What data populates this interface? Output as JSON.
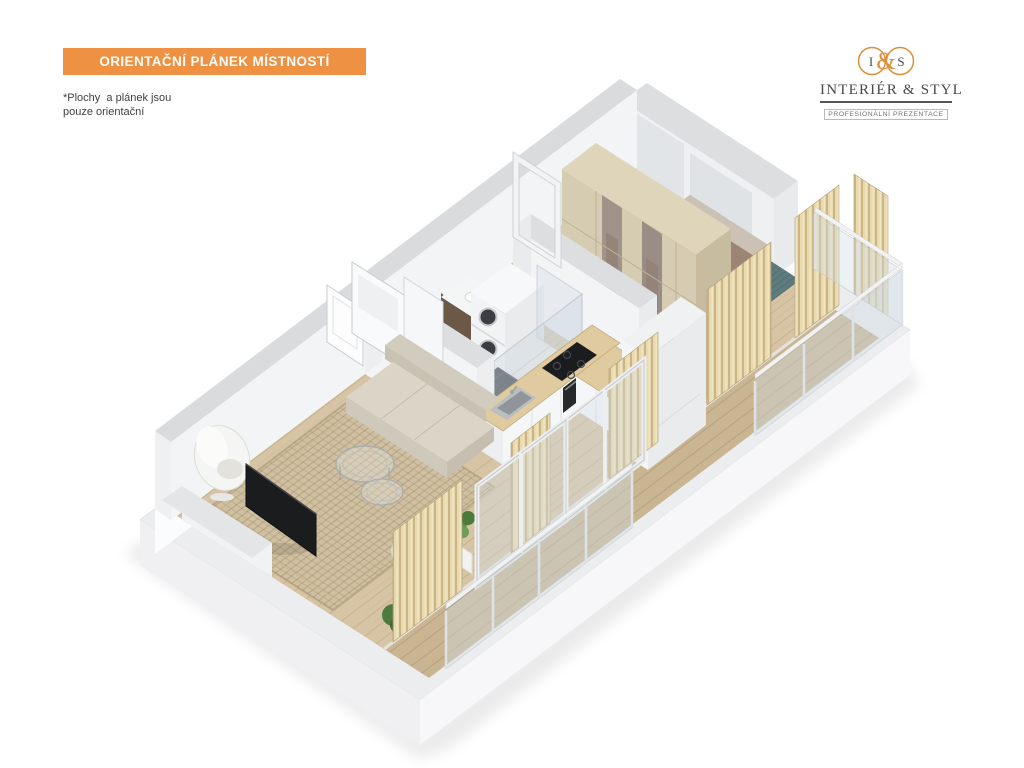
{
  "header": {
    "banner_title": "ORIENTAČNÍ PLÁNEK MÍSTNOSTÍ"
  },
  "note": {
    "line1": "*Plochy  a plánek jsou",
    "line2": "pouze orientační"
  },
  "logo": {
    "left_letter": "I",
    "ampersand": "&",
    "right_letter": "S",
    "name": "INTERIÉR & STYL",
    "tagline": "PROFESIONÁLNÍ PREZENTACE"
  },
  "palette": {
    "banner_orange": "#ef9143",
    "logo_orange": "#d8903d",
    "note_text": "#3f3f3f",
    "wall_top_gray": "#d9dbdd",
    "wall_face_white": "#f2f4f5",
    "floor_wood": "#d7c4a5",
    "balcony_wood": "#cab593",
    "bathroom_marble": "#edebe8",
    "living_rug_beige": "#cfc0a2",
    "bedroom_rug_teal": "#5e7c7e",
    "bed_duvet_taupe": "#9c8574",
    "wardrobe_beige": "#d6ccb1",
    "slat_curtain_tan": "#e8d9af",
    "counter_wood": "#e0ca9f",
    "appliance_black": "#1b1c1e",
    "sofa_beige": "#dad4c7",
    "plant_green": "#578a42",
    "glass_blue": "#cfd9e0"
  }
}
